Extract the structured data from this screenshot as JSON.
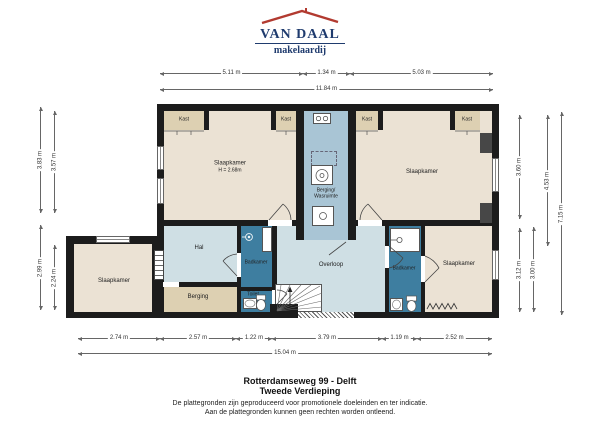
{
  "logo": {
    "brand": "VAN DAAL",
    "tagline": "makelaardij"
  },
  "plan": {
    "rooms": {
      "slaapkamer_tl": {
        "label": "Slaapkamer",
        "height": "H = 2.68m"
      },
      "slaapkamer_tr": {
        "label": "Slaapkamer"
      },
      "slaapkamer_left": {
        "label": "Slaapkamer"
      },
      "slaapkamer_br": {
        "label": "Slaapkamer"
      },
      "berging_wasruimte": {
        "line1": "Berging/",
        "line2": "Wasruimte"
      },
      "hal": {
        "label": "Hal"
      },
      "overloop": {
        "label": "Overloop"
      },
      "badkamer_center": {
        "label": "Badkamer"
      },
      "badkamer_right": {
        "label": "Badkamer"
      },
      "toilet": {
        "label": "Toilet"
      },
      "berging": {
        "label": "Berging"
      },
      "kast": {
        "label": "Kast"
      }
    },
    "dimensions": {
      "top": [
        "5.11 m",
        "1.34 m",
        "5.03 m"
      ],
      "top_total": "11.84 m",
      "bottom": [
        "2.74 m",
        "2.57 m",
        "1.22 m",
        "3.79 m",
        "1.19 m",
        "2.52 m"
      ],
      "bottom_total": "15.04 m",
      "left": [
        "3.83 m",
        "3.57 m",
        "2.99 m",
        "2.24 m"
      ],
      "right": [
        "3.60 m",
        "4.53 m",
        "7.15 m",
        "3.12 m",
        "3.00 m"
      ]
    },
    "colors": {
      "wall": "#1c1c1c",
      "shaft": "#474747",
      "room_beige": "#ebe2d4",
      "closet_tan": "#ddd0b2",
      "circulation_blue": "#cfdfe4",
      "laundry_blue": "#a9c5d5",
      "bath_blue": "#3e7ea0",
      "brand_navy": "#1f3b6e",
      "brand_red": "#b23a30"
    }
  },
  "footer": {
    "address": "Rotterdamseweg 99 - Delft",
    "floor": "Tweede Verdieping",
    "disclaimer_line1": "De plattegronden zijn geproduceerd voor promotionele doeleinden en ter indicatie.",
    "disclaimer_line2": "Aan de plattegronden kunnen geen rechten worden ontleend."
  }
}
